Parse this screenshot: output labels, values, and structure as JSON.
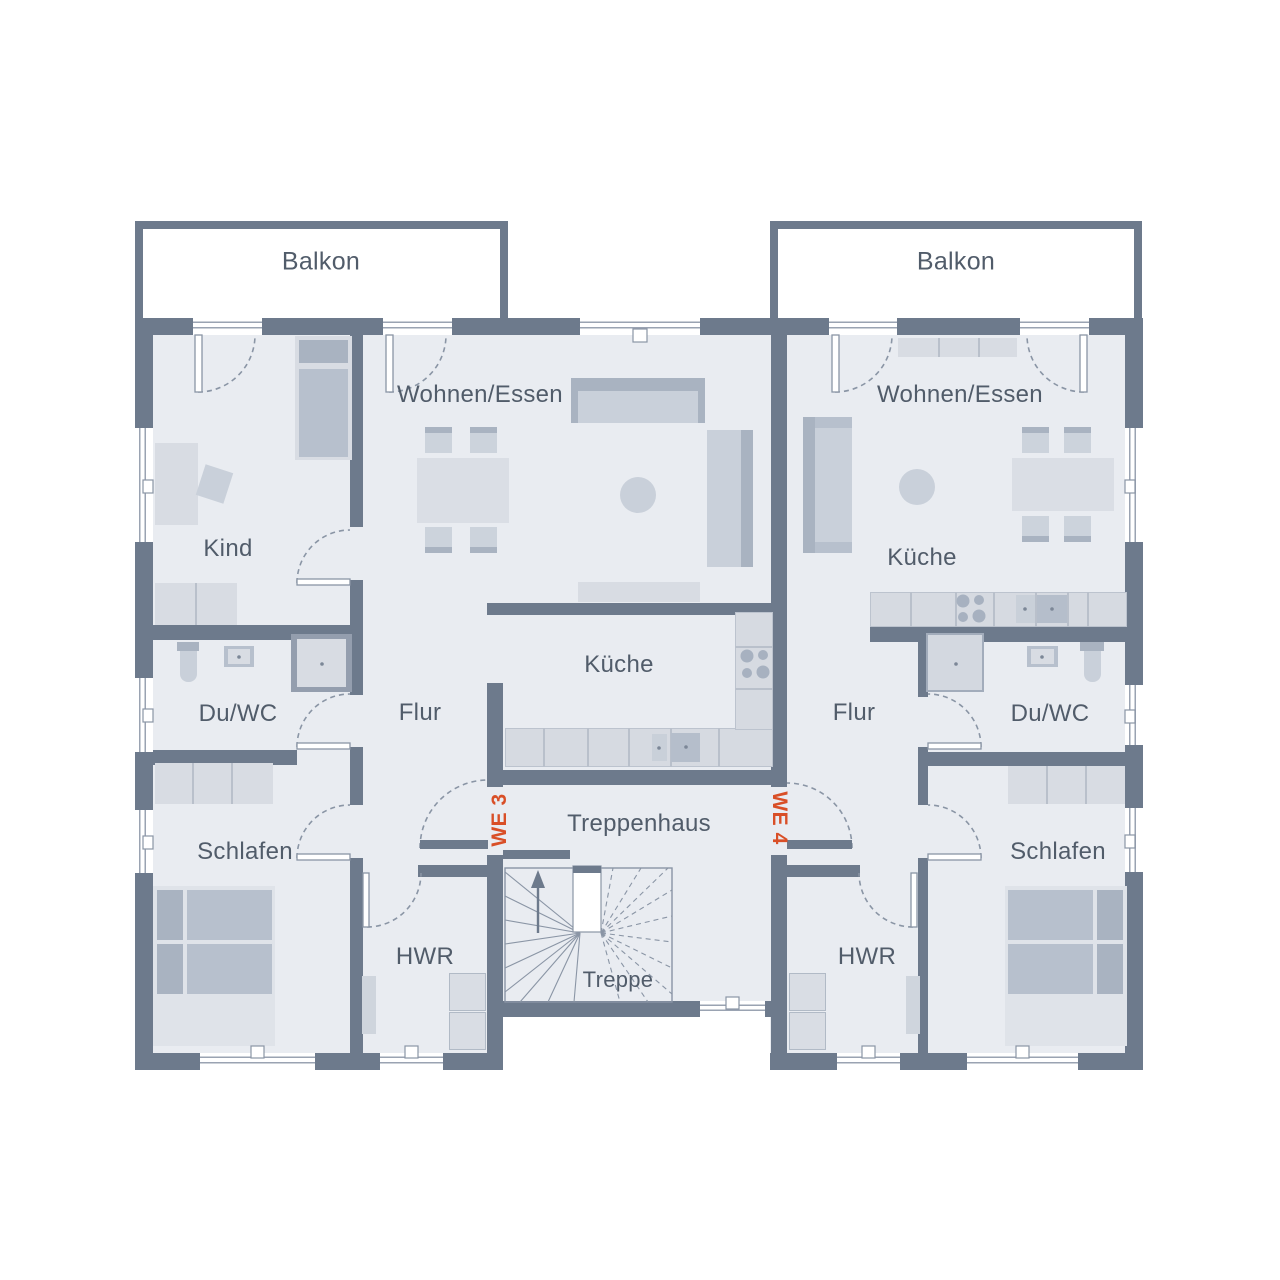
{
  "title": "Obergeschoss Grundriss",
  "labels": {
    "balcony_left": "Balkon",
    "balcony_right": "Balkon",
    "living_left": "Wohnen/Essen",
    "living_right": "Wohnen/Essen",
    "child_room": "Kind",
    "kitchen_left": "Küche",
    "kitchen_right": "Küche",
    "hall_left": "Flur",
    "hall_right": "Flur",
    "bath_left": "Du/WC",
    "bath_right": "Du/WC",
    "bedroom_left": "Schlafen",
    "bedroom_right": "Schlafen",
    "utility_left": "HWR",
    "utility_right": "HWR",
    "stair_hall": "Treppenhaus",
    "stair": "Treppe",
    "unit_3": "WE 3",
    "unit_4": "WE 4"
  },
  "colors": {
    "wall": "#6d7a8c",
    "room_fill": "#e9ecf1",
    "furniture_light": "#d8dce3",
    "furniture_mid": "#c9d0da",
    "furniture_dark": "#a9b3c1",
    "line": "#8a95a5",
    "label_text": "#515c6a",
    "unit_accent": "#d94f27",
    "background": "#ffffff"
  }
}
